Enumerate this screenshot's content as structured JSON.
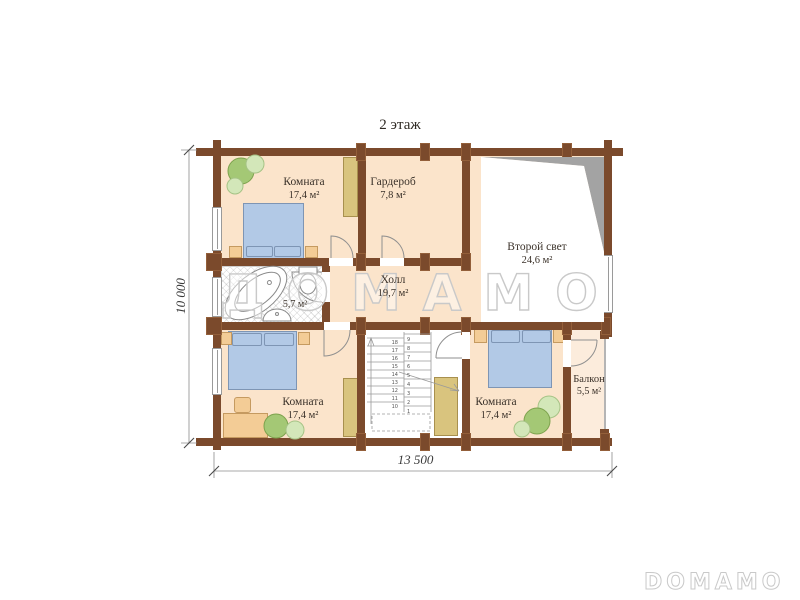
{
  "page": {
    "title": "2 этаж"
  },
  "rooms": {
    "room_top_left": {
      "name": "Комната",
      "area": "17,4 м²"
    },
    "wardrobe": {
      "name": "Гардероб",
      "area": "7,8 м²"
    },
    "second_light": {
      "name": "Второй свет",
      "area": "24,6 м²"
    },
    "hall": {
      "name": "Холл",
      "area": "19,7 м²"
    },
    "bathroom": {
      "name": "",
      "area": "5,7 м²"
    },
    "room_bottom_left": {
      "name": "Комната",
      "area": "17,4 м²"
    },
    "room_bottom_middle": {
      "name": "Комната",
      "area": "17,4 м²"
    },
    "balcony": {
      "name": "Балкон",
      "area": "5,5 м²"
    }
  },
  "dimensions": {
    "vertical": "10 000",
    "horizontal": "13 500"
  },
  "watermarks": {
    "center": "ДОМАМО",
    "bottom_right": "DOMAMO"
  },
  "stairs": {
    "left_steps": [
      "18",
      "17",
      "16",
      "15",
      "14",
      "13",
      "12",
      "11",
      "10"
    ],
    "right_steps": [
      "9",
      "8",
      "7",
      "6",
      "5",
      "4",
      "3",
      "2",
      "1"
    ]
  },
  "colors": {
    "wall": "#7b4a2c",
    "wall_outline": "#935f3a",
    "floor": "#fbe4cb",
    "balcony_floor": "#fcecdc",
    "shadow": "#a3a3a3",
    "bed": "#b2c9e6",
    "bed_border": "#7e95b4",
    "wardrobe": "#d9c47e",
    "wardrobe_border": "#a8904e",
    "cabinet": "#f3cc96",
    "cabinet_border": "#c59a60",
    "plant_dark": "#a4c875",
    "plant_dark_border": "#7da24d",
    "plant_light": "#d3e7b9",
    "plant_light_border": "#a6c386",
    "line": "#8f8f8f",
    "text": "#3b322a",
    "watermark": "#c9c9c9"
  }
}
